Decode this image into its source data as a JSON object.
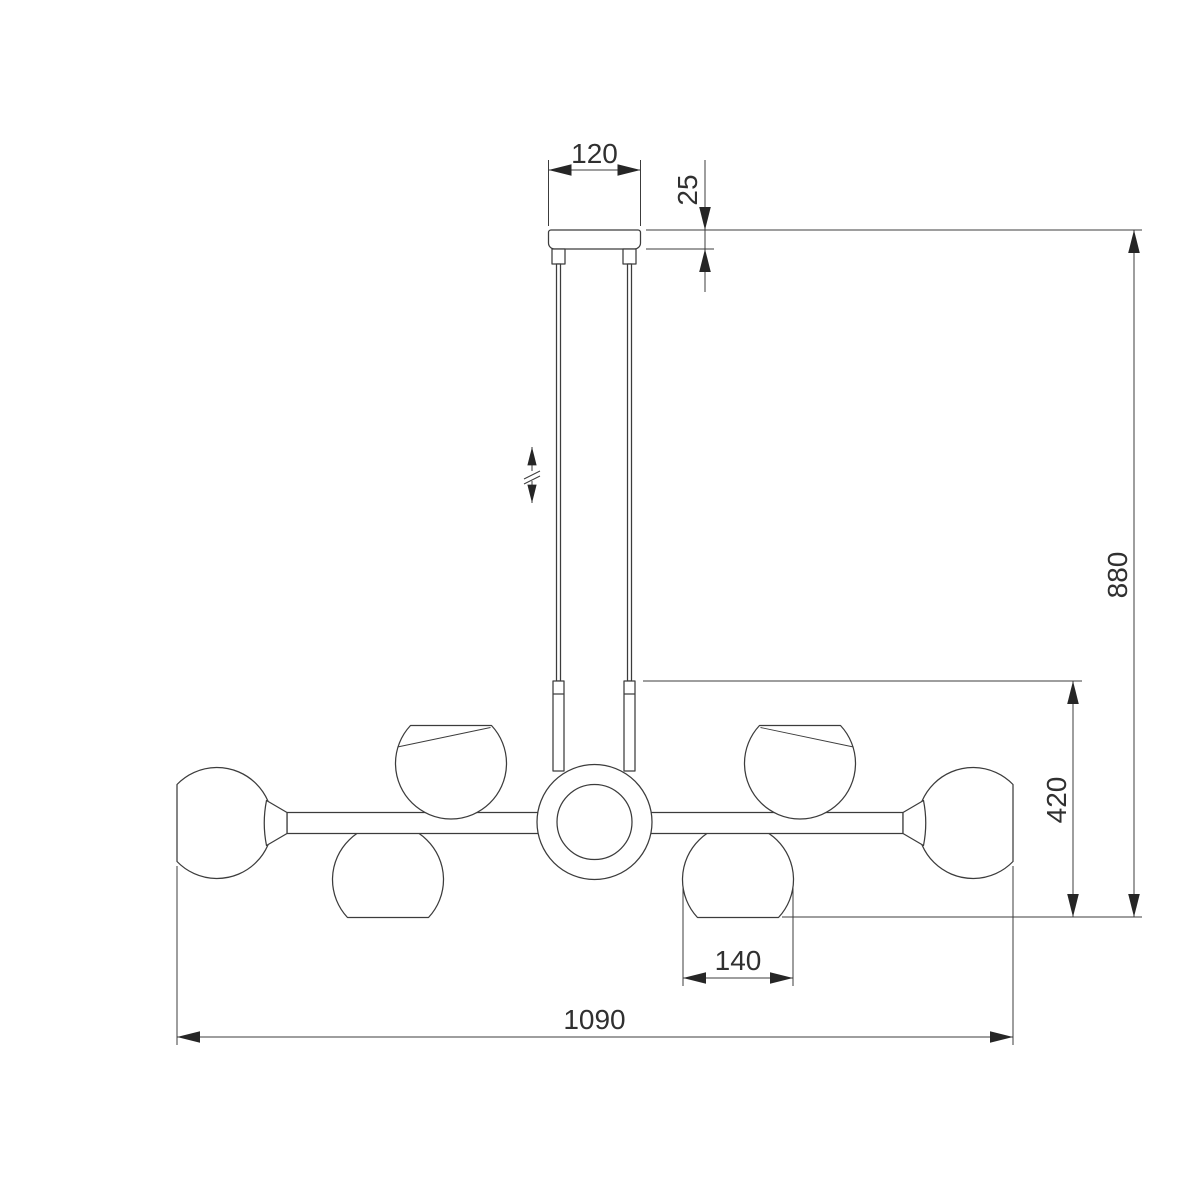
{
  "drawing": {
    "background_color": "#ffffff",
    "line_color": "#3c3c3c",
    "text_color": "#303030",
    "arrow_color": "#262626",
    "dimensions": {
      "canopy_width": "120",
      "canopy_height": "25",
      "overall_height": "880",
      "body_height": "420",
      "shade_width": "140",
      "overall_width": "1090"
    }
  }
}
